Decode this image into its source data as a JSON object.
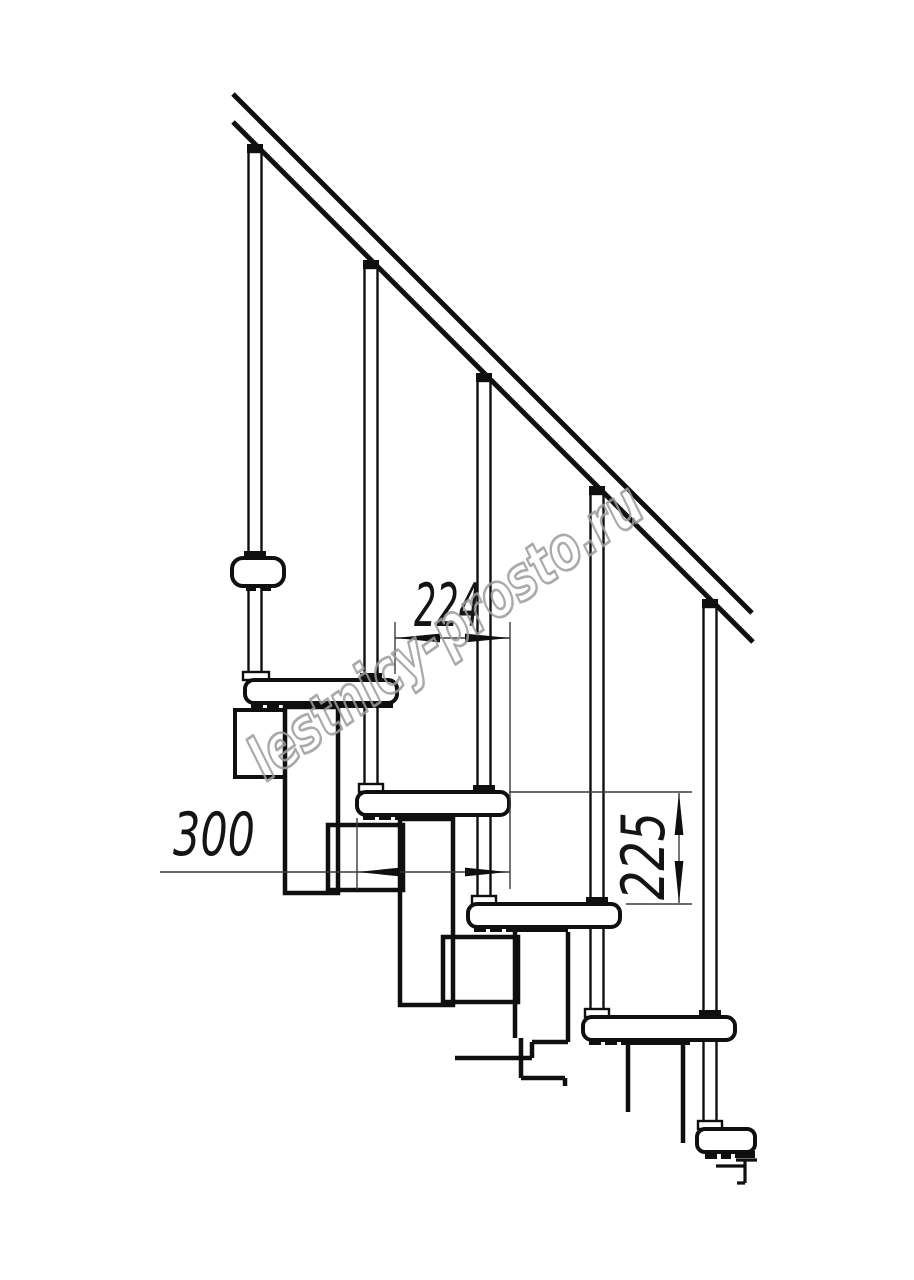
{
  "drawing": {
    "type": "technical-drawing",
    "subject": "modular-staircase-side-elevation",
    "watermark": "lestnicy-prosto.ru",
    "dimensions": [
      {
        "label": "224",
        "orientation": "horizontal"
      },
      {
        "label": "300",
        "orientation": "horizontal"
      },
      {
        "label": "225",
        "orientation": "vertical"
      }
    ],
    "colors": {
      "background": "#ffffff",
      "ink": "#0f0f0f",
      "thin_line": "#3a3a3a",
      "watermark": "#9c9c9c"
    }
  }
}
